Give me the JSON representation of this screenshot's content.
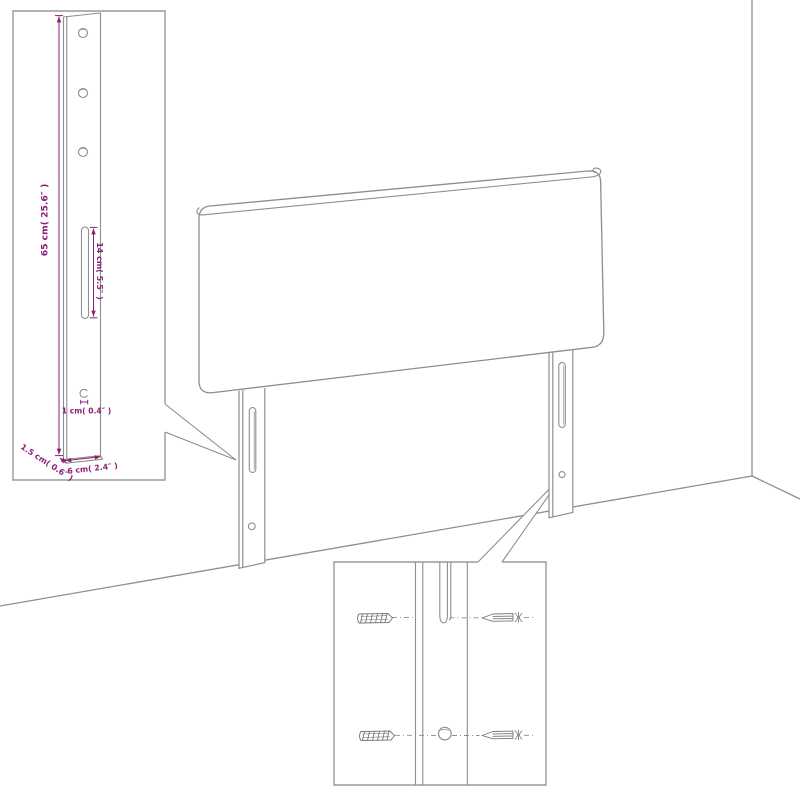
{
  "diagram": {
    "kind": "headboard assembly / dimension diagram",
    "colors": {
      "background": "#ffffff",
      "line": "#8e8e8e",
      "dimension_accent": "#8b1f78"
    },
    "leg_detail_inset": {
      "dim_height": "65 cm( 25.6″ )",
      "dim_slot": "14 cm( 5.5″ )",
      "dim_hole": "1 cm( 0.4″ )",
      "dim_thickness": "1.5 cm( 0.6″ )",
      "dim_width": "6 cm( 2.4″ )"
    }
  }
}
